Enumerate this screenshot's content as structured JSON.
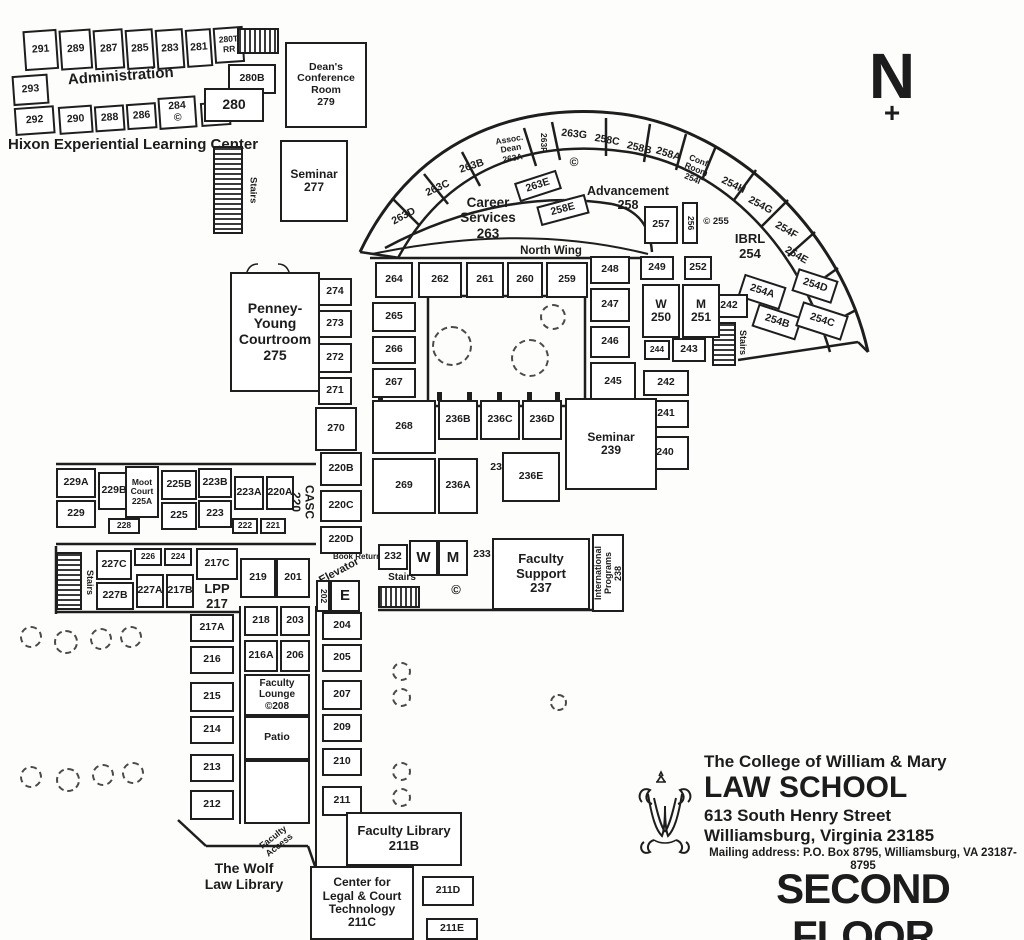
{
  "page": {
    "floor_title": "SECOND FLOOR",
    "compass_n": "N",
    "compass_plus": "+"
  },
  "branding": {
    "college": "The College of William & Mary",
    "school": "LAW SCHOOL",
    "street": "613 South Henry Street",
    "city": "Williamsburg, Virginia 23185",
    "mailing": "Mailing address: P.O. Box 8795, Williamsburg, VA 23187-8795"
  },
  "labels": {
    "administration": "Administration",
    "hixon": "Hixon Experiential Learning Center",
    "north_wing": "North Wing",
    "stairs": "Stairs",
    "elevator": "Elevator",
    "book_return": "Book Return",
    "patio": "Patio",
    "faculty_access": "Faculty\nAccess",
    "wolf_library": "The Wolf\nLaw Library",
    "w": "W",
    "m": "M",
    "e": "E",
    "c": "©"
  },
  "rooms": {
    "291": "291",
    "289": "289",
    "287": "287",
    "285": "285",
    "283": "283",
    "281": "281",
    "280T": "280T\nRR",
    "293": "293",
    "292": "292",
    "290": "290",
    "288": "288",
    "286": "286",
    "284": "284\n©",
    "282": "282",
    "280": "280",
    "280B": "280B",
    "279": "Dean's\nConference\nRoom\n279",
    "277": "Seminar\n277",
    "263D": "263D",
    "263C": "263C",
    "263B": "263B",
    "263A": "Assoc.\nDean\n263A",
    "263F": "263F",
    "263G": "263G",
    "258C": "258C",
    "258B": "258B",
    "258A": "258A",
    "254I": "Conf.\nRoom\n254I",
    "254H": "254H",
    "254G": "254G",
    "254F": "254F",
    "254E": "254E",
    "254D": "254D",
    "254C": "254C",
    "254A": "254A",
    "254B": "254B",
    "263": "Career\nServices\n263",
    "263E": "263E",
    "258E": "258E",
    "258": "Advancement\n258",
    "257": "257",
    "256": "256",
    "255": "© 255",
    "254": "IBRL\n254",
    "264": "264",
    "262": "262",
    "261": "261",
    "260": "260",
    "259": "259",
    "248": "248",
    "247": "247",
    "246": "246",
    "245": "245",
    "265": "265",
    "266": "266",
    "267": "267",
    "249": "249",
    "252": "252",
    "250": "W\n250",
    "251": "M\n251",
    "244": "244",
    "243": "243",
    "242": "242",
    "241": "241",
    "240": "240",
    "239": "Seminar\n239",
    "268": "268",
    "269": "269",
    "236B": "236B",
    "236C": "236C",
    "236D": "236D",
    "236A": "236A",
    "236": "236",
    "236E": "236E",
    "229A": "229A",
    "229B": "229B",
    "225A": "Moot\nCourt\n225A",
    "225B": "225B",
    "223B": "223B",
    "223A": "223A",
    "220A": "220A",
    "229": "229",
    "228": "228",
    "225": "225",
    "223": "223",
    "222": "222",
    "221": "221",
    "220": "CASC\n220",
    "220B": "220B",
    "220C": "220C",
    "220D": "220D",
    "227C": "227C",
    "226": "226",
    "224": "224",
    "217C": "217C",
    "227B": "227B",
    "227A": "227A",
    "217B": "217B",
    "217": "LPP\n217",
    "217A": "217A",
    "216": "216",
    "215": "215",
    "214": "214",
    "213": "213",
    "212": "212",
    "219": "219",
    "201": "201",
    "218": "218",
    "203": "203",
    "216A": "216A",
    "206": "206",
    "204": "204",
    "205": "205",
    "207": "207",
    "209": "209",
    "210": "210",
    "211": "211",
    "202": "202",
    "208": "Faculty\nLounge\n©208",
    "232": "232",
    "233": "233",
    "237": "Faculty\nSupport\n237",
    "238": "International\nPrograms\n238",
    "275": "Penney-Young\nCourtroom\n275",
    "274": "274",
    "273": "273",
    "272": "272",
    "271": "271",
    "270": "270",
    "211B": "Faculty Library\n211B",
    "211C": "Center for\nLegal & Court\nTechnology\n211C",
    "211D": "211D",
    "211E": "211E"
  }
}
